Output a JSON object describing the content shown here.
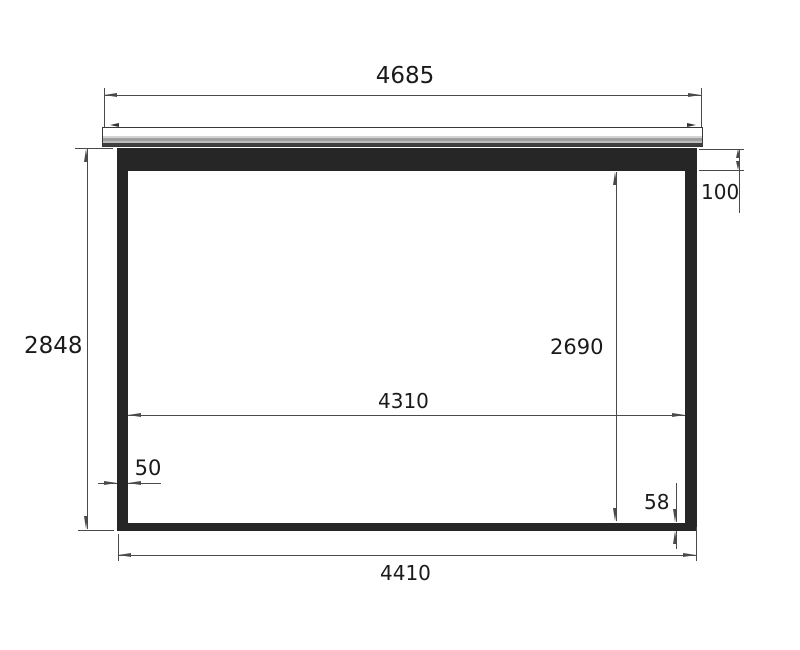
{
  "drawing": {
    "type": "projection-screen-dimension-diagram",
    "dimensions": {
      "case_width": "4685",
      "total_height": "2848",
      "top_border_height": "100",
      "viewing_height": "2690",
      "viewing_width": "4310",
      "side_border_width": "50",
      "bottom_border_height": "58",
      "cloth_width": "4410"
    },
    "colors": {
      "background": "#ffffff",
      "line": "#4a4a4a",
      "cloth": "#262626",
      "casing_stripe": "#9e9e9e"
    }
  }
}
